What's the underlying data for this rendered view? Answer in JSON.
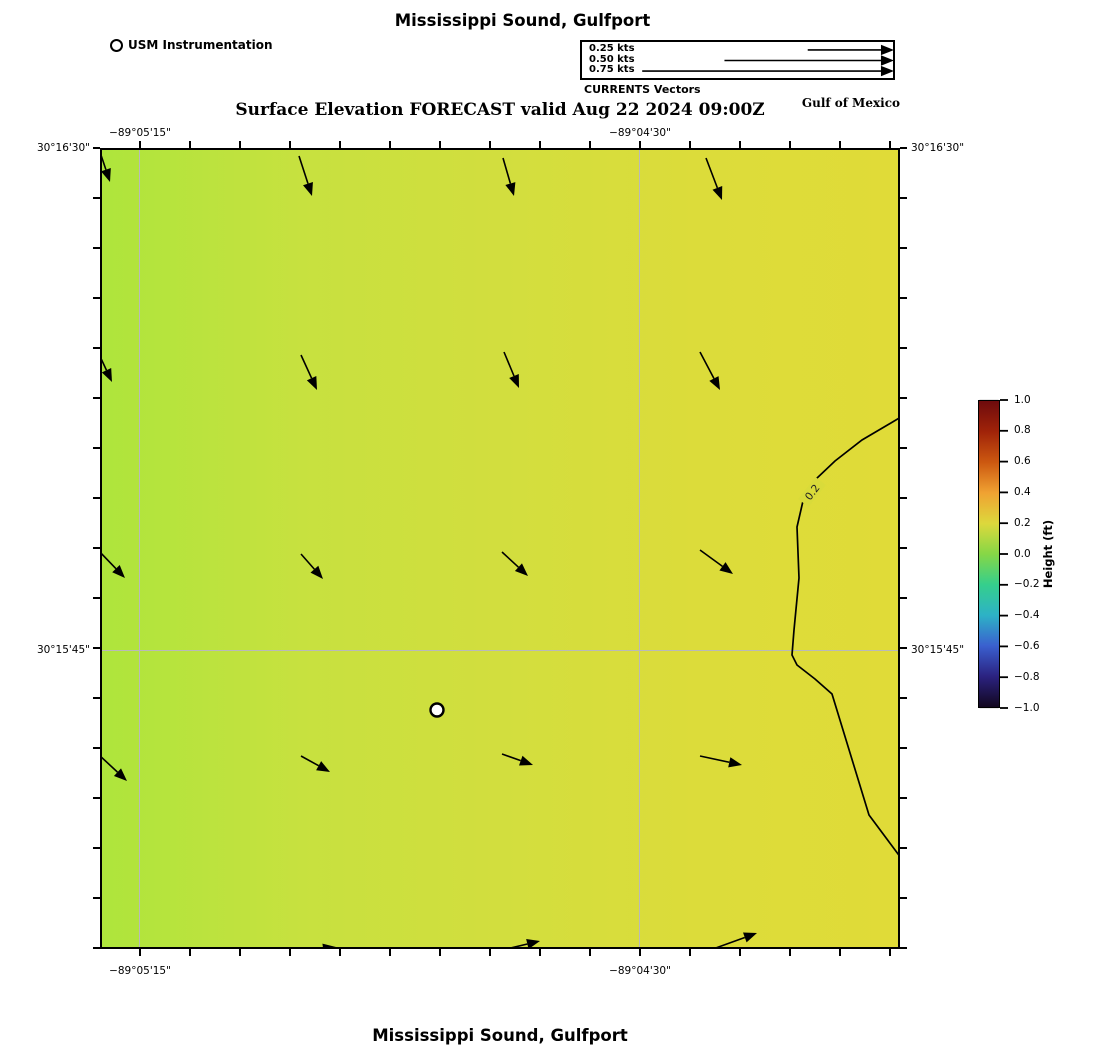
{
  "header": {
    "title": "Mississippi Sound, Gulfport",
    "station_legend_label": "USM Instrumentation",
    "vector_legend": {
      "rows": [
        {
          "label": "0.25 kts",
          "tail_x": 225,
          "y": 7.5
        },
        {
          "label": "0.50 kts",
          "tail_x": 142,
          "y": 18
        },
        {
          "label": "0.75 kts",
          "tail_x": 60,
          "y": 28.5
        }
      ],
      "tip_x": 311,
      "caption": "CURRENTS Vectors"
    },
    "subtitle": "Surface Elevation FORECAST valid Aug 22 2024 09:00Z",
    "region_label": "Gulf of Mexico"
  },
  "footer": {
    "title": "Mississippi Sound, Gulfport"
  },
  "chart_data": {
    "type": "heatmap",
    "title": "Surface Elevation FORECAST valid Aug 22 2024 09:00Z",
    "x_axis": {
      "tick_labels": [
        "−89°05'15\"",
        "−89°04'30\""
      ],
      "tick_positions_px": [
        140,
        640
      ],
      "minor_tick_spacing_px": 50
    },
    "y_axis": {
      "tick_labels": [
        "30°16'30\"",
        "30°15'45\""
      ],
      "tick_positions_px": [
        148,
        650
      ],
      "minor_tick_spacing_px": 50
    },
    "plot_area_px": {
      "left": 100,
      "top": 148,
      "right": 900,
      "bottom": 949
    },
    "field": {
      "description": "surface elevation ~0.1 to 0.2 ft, increasing west to east",
      "fill_gradient": [
        "#aee53c",
        "#c7e13f",
        "#d2de3e",
        "#dcdc3a",
        "#e0db38"
      ]
    },
    "grid_color": "#b9b9b9",
    "contour": {
      "level": "0.2",
      "label": "0.2",
      "points_px": [
        [
          901,
          417
        ],
        [
          862,
          440
        ],
        [
          835,
          461
        ],
        [
          816,
          479
        ],
        [
          803,
          501
        ],
        [
          797,
          527
        ],
        [
          799,
          578
        ],
        [
          794,
          630
        ],
        [
          792,
          655
        ],
        [
          797,
          665
        ],
        [
          815,
          679
        ],
        [
          832,
          694
        ],
        [
          869,
          815
        ],
        [
          901,
          858
        ]
      ],
      "label_pos_px": [
        812,
        492
      ],
      "label_rotation_deg": -52,
      "label_bg": "#d9db3a"
    },
    "station_marker": {
      "name": "USM Instrumentation",
      "pos_px": [
        437,
        710
      ]
    },
    "current_vectors_px": [
      [
        100,
        152,
        110,
        182
      ],
      [
        299,
        156,
        312,
        196
      ],
      [
        503,
        158,
        514,
        196
      ],
      [
        706,
        158,
        722,
        200
      ],
      [
        97,
        350,
        112,
        382
      ],
      [
        301,
        355,
        317,
        390
      ],
      [
        504,
        352,
        519,
        388
      ],
      [
        700,
        352,
        720,
        390
      ],
      [
        97,
        549,
        125,
        578
      ],
      [
        301,
        554,
        323,
        579
      ],
      [
        502,
        552,
        528,
        576
      ],
      [
        700,
        550,
        733,
        574
      ],
      [
        98,
        754,
        127,
        781
      ],
      [
        301,
        756,
        330,
        772
      ],
      [
        502,
        754,
        533,
        765
      ],
      [
        700,
        756,
        742,
        765
      ],
      [
        292,
        953,
        336,
        947
      ],
      [
        498,
        951,
        540,
        941
      ],
      [
        702,
        953,
        757,
        933
      ]
    ],
    "colorbar": {
      "label": "Height (ft)",
      "min": -1.0,
      "max": 1.0,
      "tick_labels": [
        "1.0",
        "0.8",
        "0.6",
        "0.4",
        "0.2",
        "0.0",
        "−0.2",
        "−0.4",
        "−0.6",
        "−0.8",
        "−1.0"
      ],
      "colors_top_to_bottom": [
        "#6e0b0d",
        "#a02309",
        "#cc5810",
        "#f0a232",
        "#ddd83c",
        "#86d746",
        "#35cf8c",
        "#2db2c6",
        "#3a60cf",
        "#2b2280",
        "#12071f"
      ],
      "bar_px": {
        "left": 978,
        "top": 400,
        "width": 22,
        "height": 308
      }
    }
  }
}
